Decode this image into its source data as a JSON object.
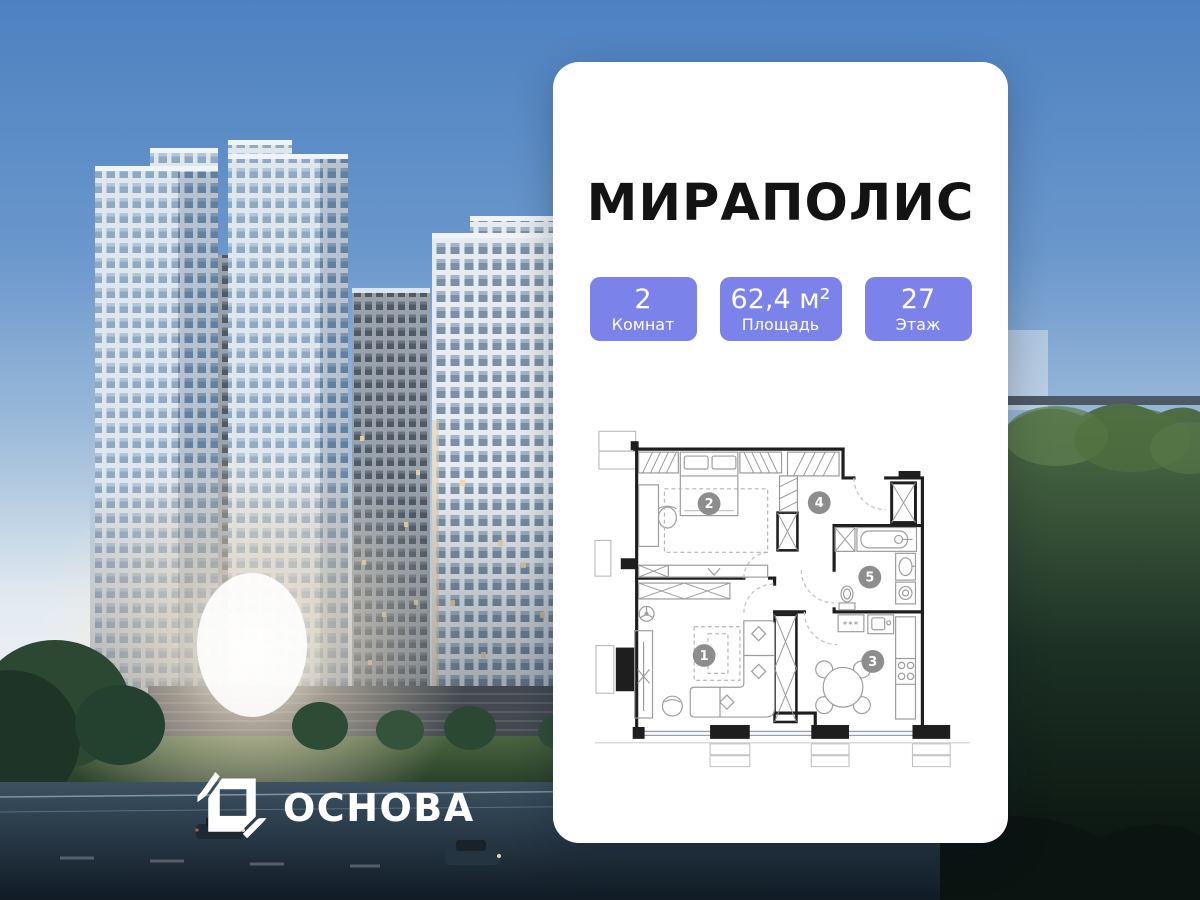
{
  "card": {
    "title": "МИРАПОЛИС",
    "stats": [
      {
        "value": "2",
        "label": "Комнат"
      },
      {
        "value": "62,4 м²",
        "label": "Площадь"
      },
      {
        "value": "27",
        "label": "Этаж"
      }
    ],
    "floor_plan": {
      "rooms": [
        {
          "number": "1"
        },
        {
          "number": "2"
        },
        {
          "number": "3"
        },
        {
          "number": "4"
        },
        {
          "number": "5"
        }
      ],
      "counter_label": "***"
    }
  },
  "logo": {
    "text": "ОСНОВА"
  },
  "colors": {
    "stat_badge": "#7b82e9",
    "card_background": "#ffffff",
    "title_text": "#131313",
    "room_badge": "#8d8d8d",
    "plan_walls": "#1e1e1e",
    "sky_top": "#4d81c0",
    "logo_text": "#ffffff"
  }
}
